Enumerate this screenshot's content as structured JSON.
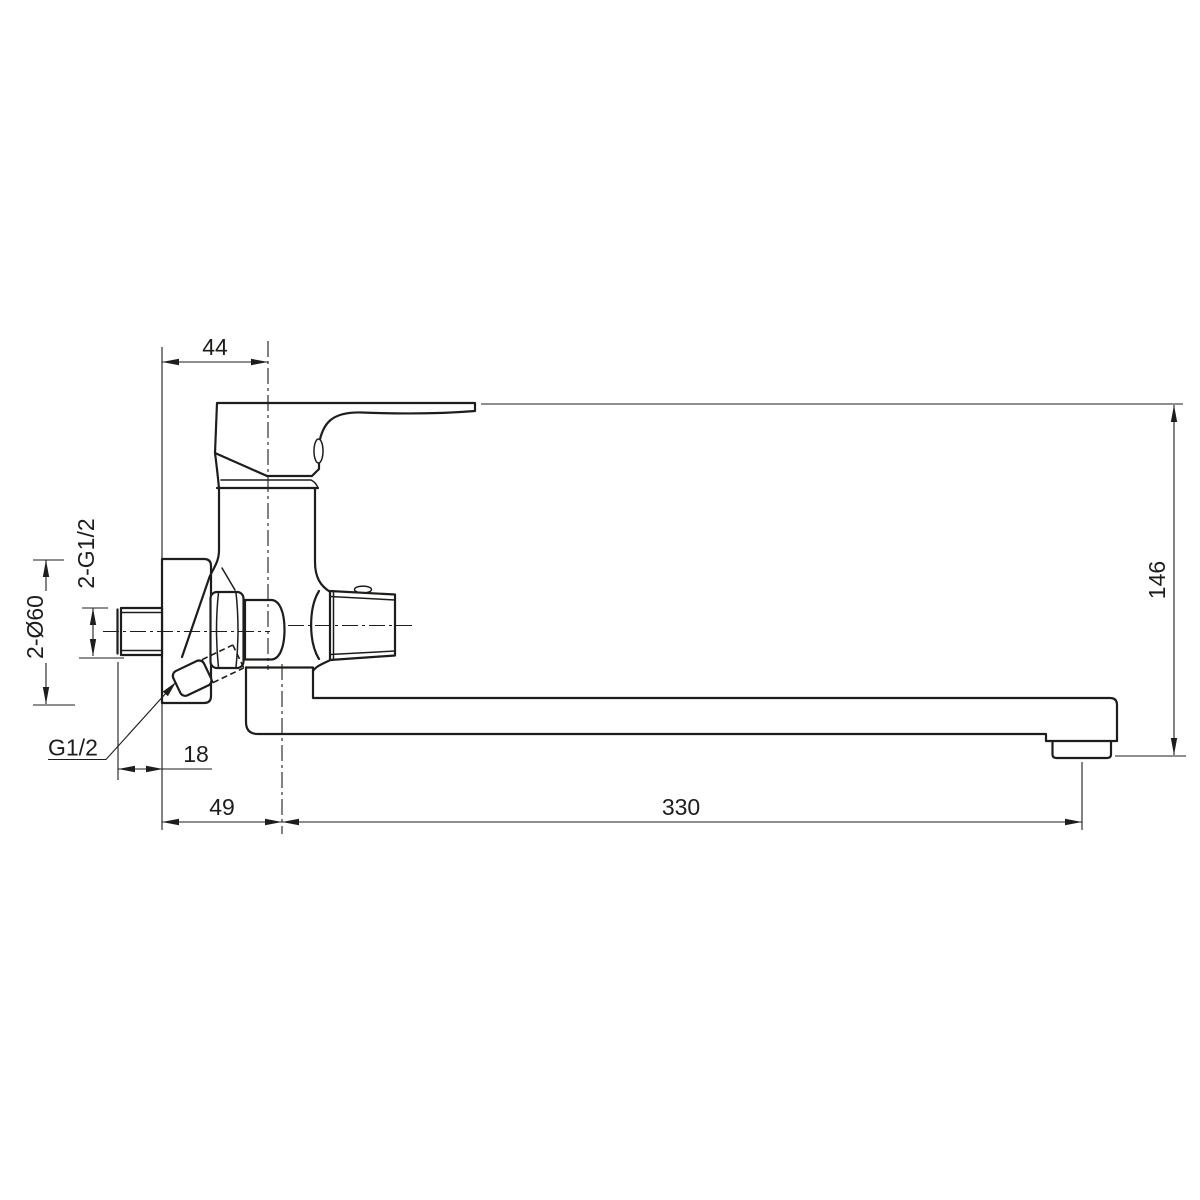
{
  "drawing": {
    "colors": {
      "line": "#1d1d1b",
      "background": "#ffffff"
    },
    "labels": {
      "handle_depth": "44",
      "overall_height": "146",
      "spout_reach": "330",
      "wall_to_spout": "49",
      "eccentric_offset": "18",
      "inlet_thread": "2-G1/2",
      "escutcheon_dia": "2-Ø60",
      "outlet_thread": "G1/2"
    }
  }
}
